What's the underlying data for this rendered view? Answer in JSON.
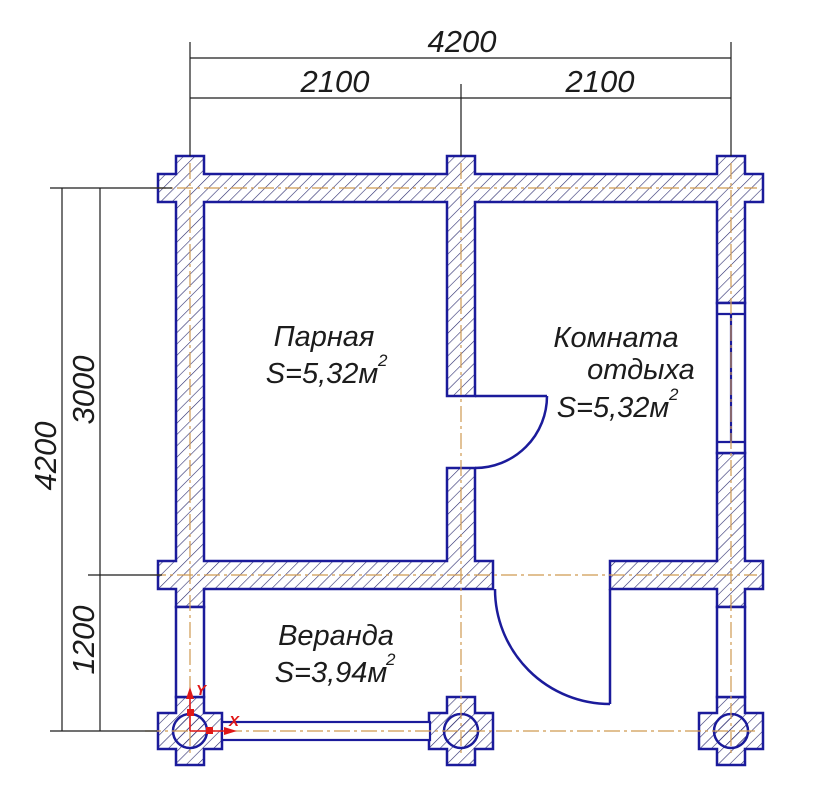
{
  "drawing": {
    "type": "bathhouse-floor-plan",
    "rooms": {
      "steam_room": {
        "name": "Парная",
        "area": "S=5,32м",
        "area_sup": "2"
      },
      "rest_room": {
        "line1": "Комната",
        "line2": "отдыха",
        "area": "S=5,32м",
        "area_sup": "2"
      },
      "veranda": {
        "name": "Веранда",
        "area": "S=3,94м",
        "area_sup": "2"
      }
    },
    "dimensions": {
      "top": {
        "total": "4200",
        "segments": [
          "2100",
          "2100"
        ]
      },
      "left": {
        "total": "4200",
        "segments": [
          "3000",
          "1200"
        ]
      }
    },
    "origin_marker": {
      "x_label": "X",
      "y_label": "Y"
    },
    "colors": {
      "wall_outline": "#1b1b9b",
      "hatch": "#2a2a6e",
      "centerline": "#cf9a52",
      "dimension": "#1c1c1c",
      "marker_red": "#e01818"
    }
  }
}
